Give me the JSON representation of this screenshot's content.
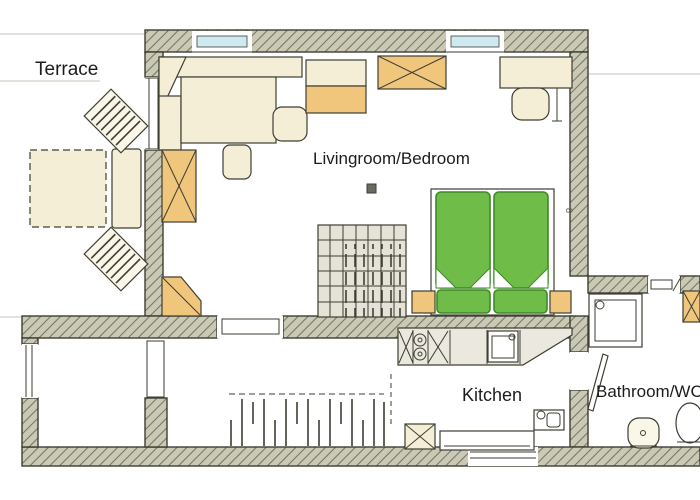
{
  "image_type": "apartment-floor-plan",
  "rooms": {
    "terrace": {
      "label": "Terrace"
    },
    "living_bedroom": {
      "label": "Livingroom/Bedroom"
    },
    "kitchen": {
      "label": "Kitchen"
    },
    "bathroom": {
      "label": "Bathroom/WC"
    }
  },
  "annotations": {
    "wall_dimension": "8"
  },
  "colors": {
    "wall-fill": "#c9c9b6",
    "wall-hatch": "#757561",
    "wall-outline": "#3e3e33",
    "furniture-cream": "#f4eed6",
    "furniture-cream-light": "#faf6e8",
    "accent-orange": "#f0c57c",
    "bed-green": "#6fbc48",
    "bed-green-dark": "#3d8a28",
    "tile-gray": "#e5e3d7",
    "counter-gray": "#ebe9df",
    "window-blue": "#cfe9f1",
    "line-faint": "#c4c4bb",
    "ink": "#1c1c1c"
  }
}
